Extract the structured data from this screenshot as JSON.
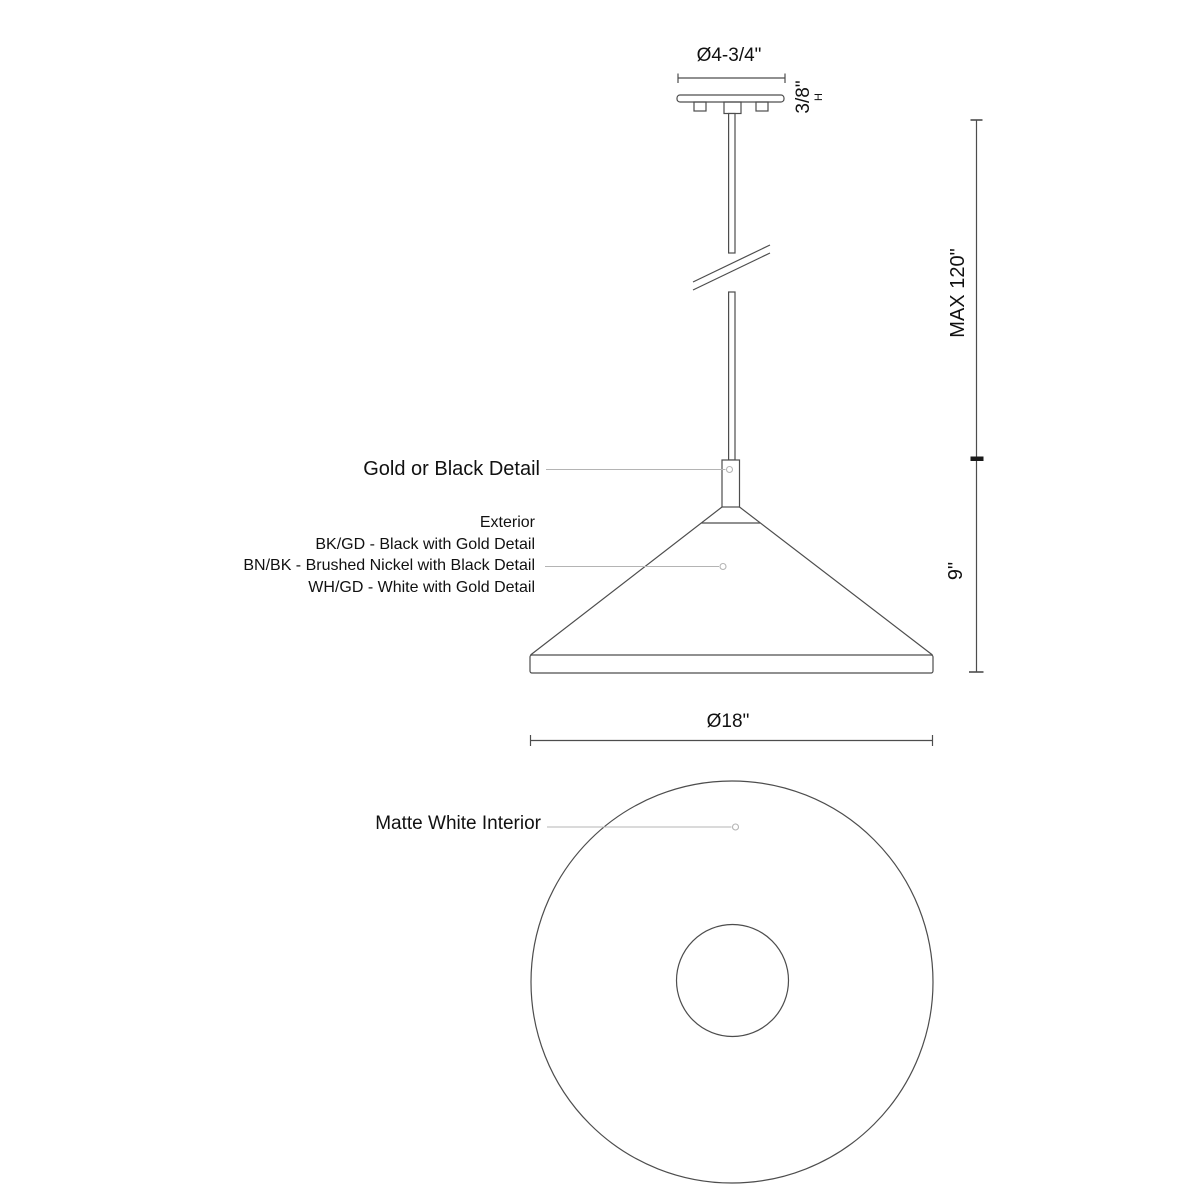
{
  "colors": {
    "line": "#4d4d4d",
    "leader": "#b4b4b4",
    "text": "#111111",
    "bg": "#ffffff"
  },
  "labels": {
    "canopy_diameter": "Ø4-3/4\"",
    "canopy_height": "3/8\"",
    "canopy_height_suffix": "H",
    "max_drop": "MAX 120\"",
    "shade_height": "9\"",
    "detail_callout": "Gold or Black Detail",
    "exterior_title": "Exterior",
    "finish_options": [
      "BK/GD - Black with Gold Detail",
      "BN/BK - Brushed Nickel with Black Detail",
      "WH/GD - White with Gold Detail"
    ],
    "shade_diameter": "Ø18\"",
    "interior_callout": "Matte White Interior"
  }
}
